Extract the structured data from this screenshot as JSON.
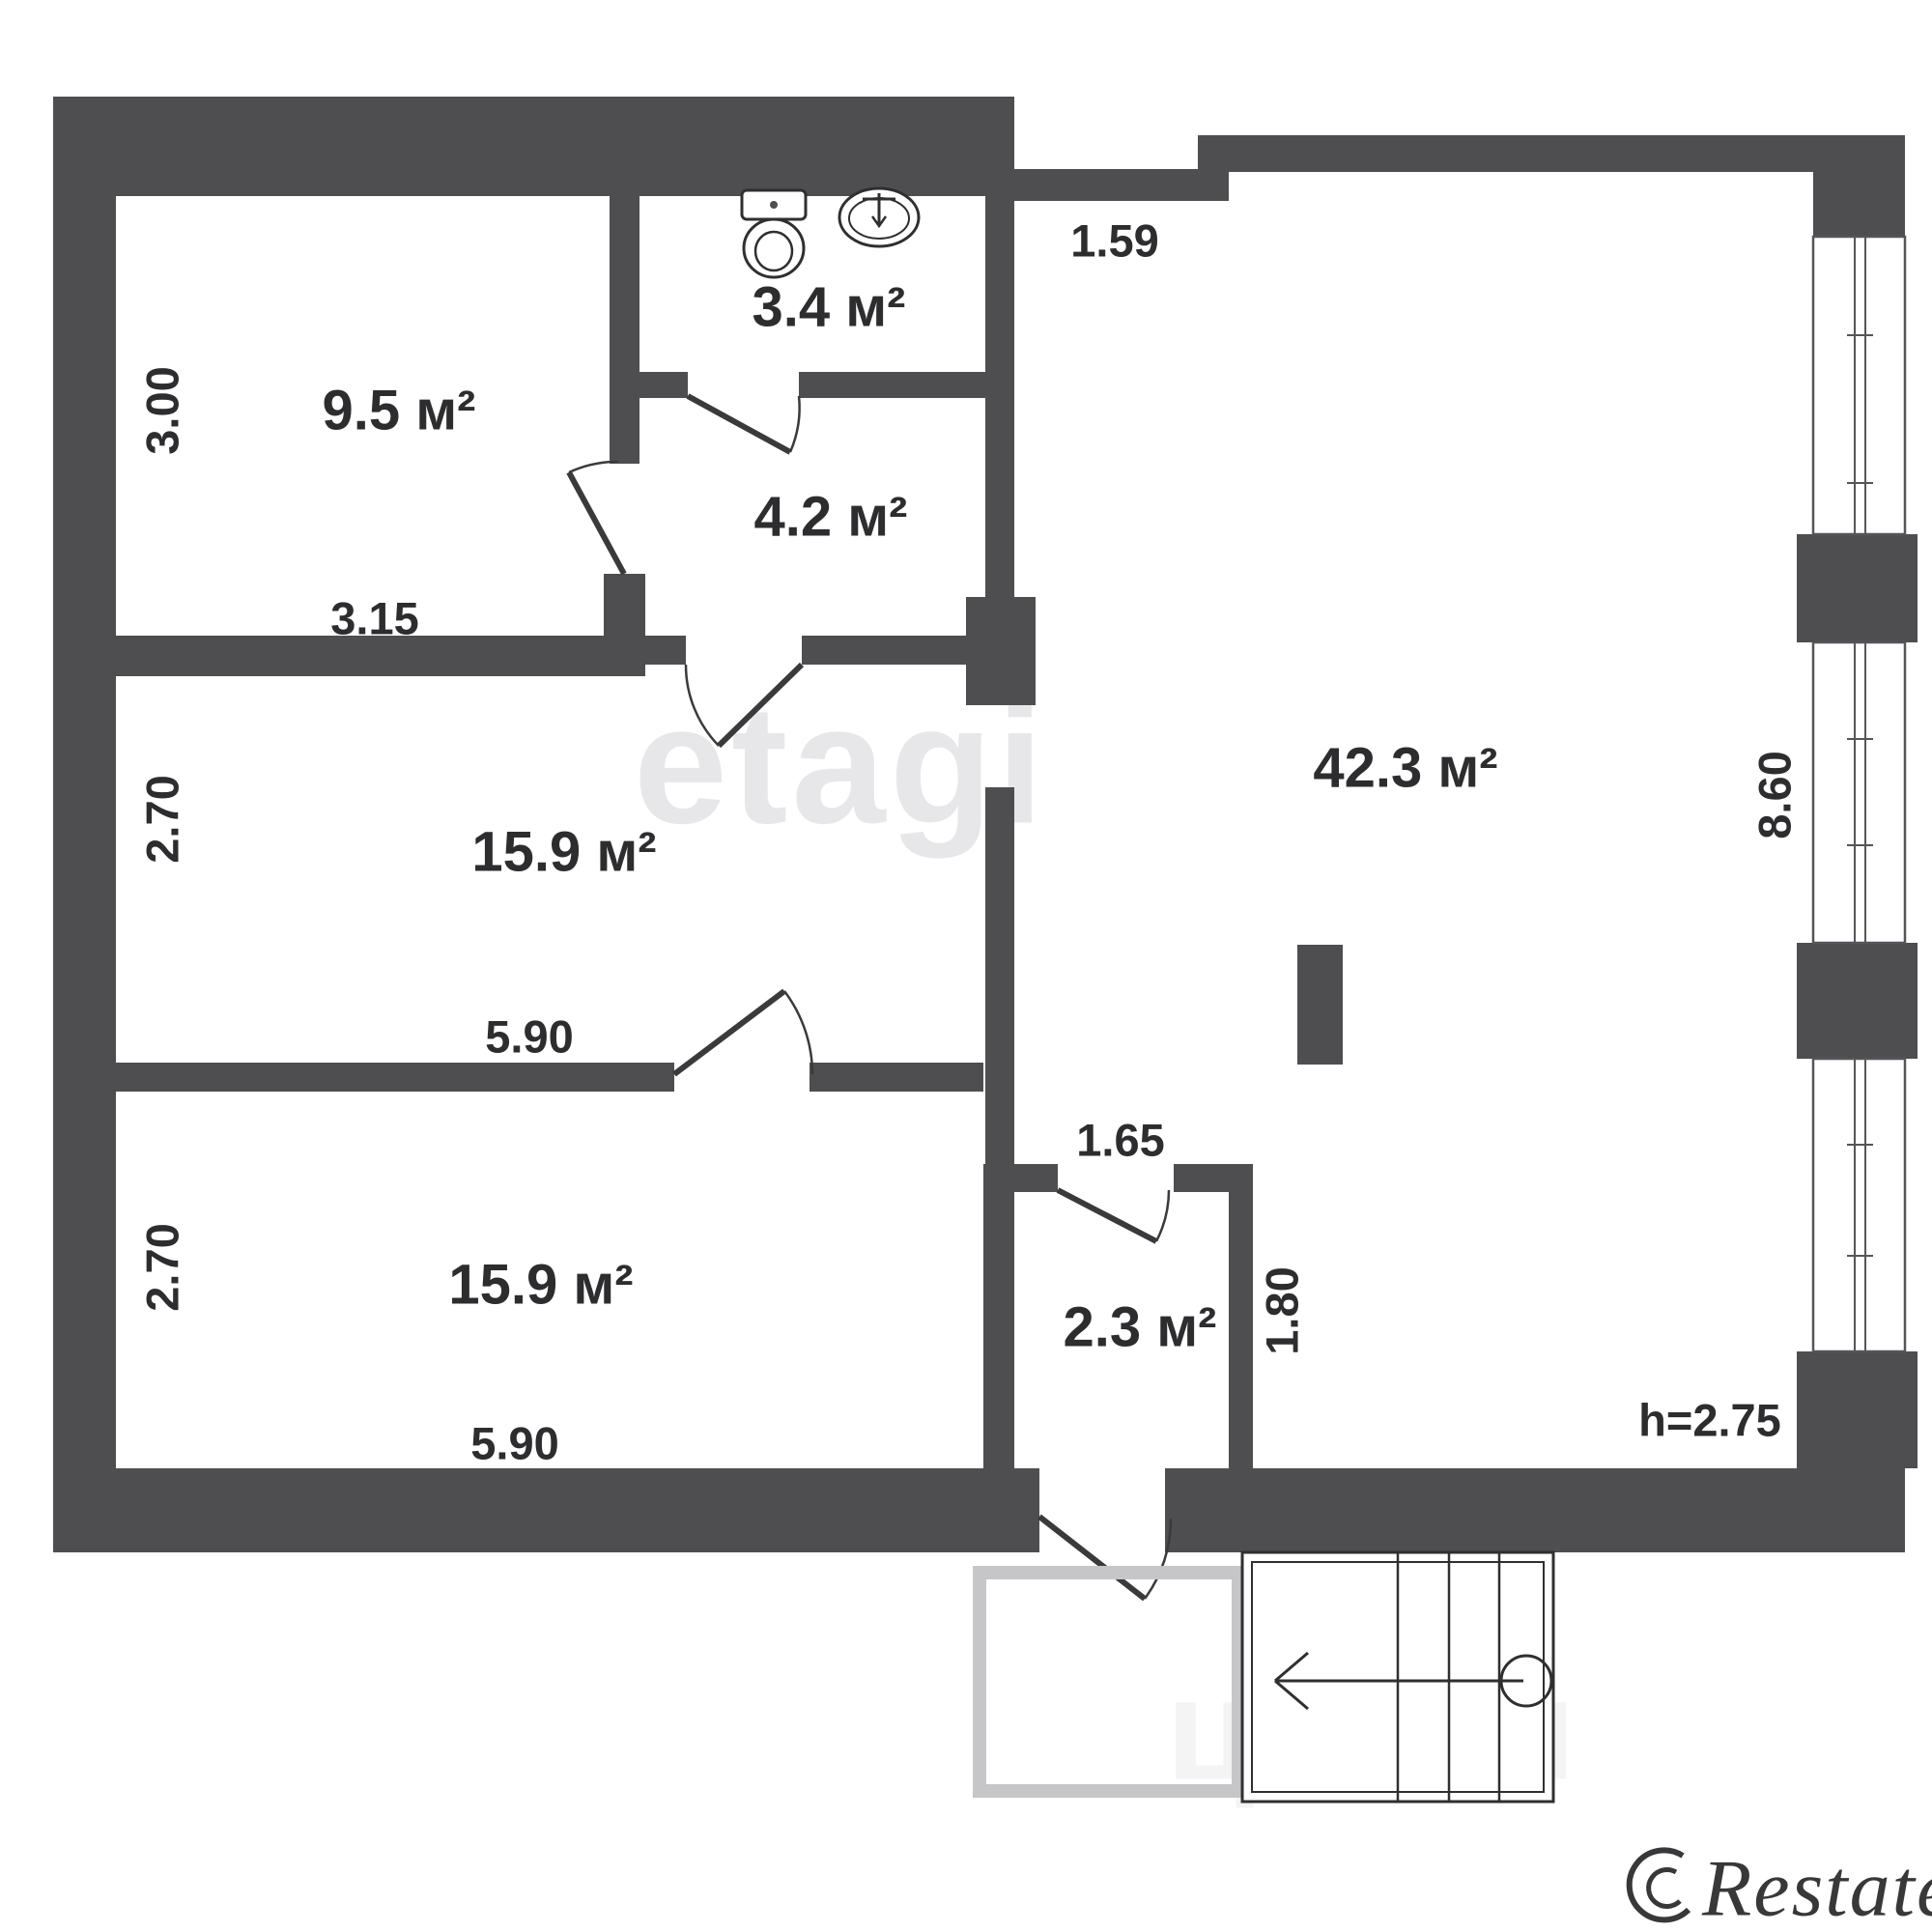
{
  "plan": {
    "title": "apartment-floor-plan",
    "ceiling_height_note": "h=2.75",
    "colors": {
      "wall": "#4e4e50",
      "line": "#2f2f31",
      "label_text": "#2d2d2f",
      "watermark_center": "#e7e7e9",
      "porch_outline": "#c6c6c8",
      "background": "#ffffff"
    },
    "rooms": [
      {
        "name": "room-9-5",
        "area": "9.5 м²"
      },
      {
        "name": "bathroom",
        "area": "3.4 м²"
      },
      {
        "name": "room-4-2",
        "area": "4.2 м²"
      },
      {
        "name": "room-15-9-upper",
        "area": "15.9 м²"
      },
      {
        "name": "hall-42-3",
        "area": "42.3 м²"
      },
      {
        "name": "room-15-9-lower",
        "area": "15.9 м²"
      },
      {
        "name": "entry-2-3",
        "area": "2.3 м²"
      }
    ]
  },
  "labels": {
    "room_9_5": "9.5 м²",
    "room_3_4": "3.4 м²",
    "room_4_2": "4.2 м²",
    "room_15_9_a": "15.9 м²",
    "room_42_3": "42.3 м²",
    "room_15_9_b": "15.9 м²",
    "room_2_3": "2.3 м²",
    "dim_3_00": "3.00",
    "dim_3_15": "3.15",
    "dim_2_70_a": "2.70",
    "dim_5_90_a": "5.90",
    "dim_2_70_b": "2.70",
    "dim_5_90_b": "5.90",
    "dim_1_59": "1.59",
    "dim_8_60": "8.60",
    "dim_1_65": "1.65",
    "dim_1_80": "1.80",
    "height_note": "h=2.75"
  },
  "watermarks": {
    "center": "etagi",
    "bottom_faint": "циан",
    "brand": "Restate"
  },
  "icons": [
    "toilet-icon",
    "sink-icon",
    "stairs-direction-arrow-icon",
    "restate-logo-icon"
  ]
}
